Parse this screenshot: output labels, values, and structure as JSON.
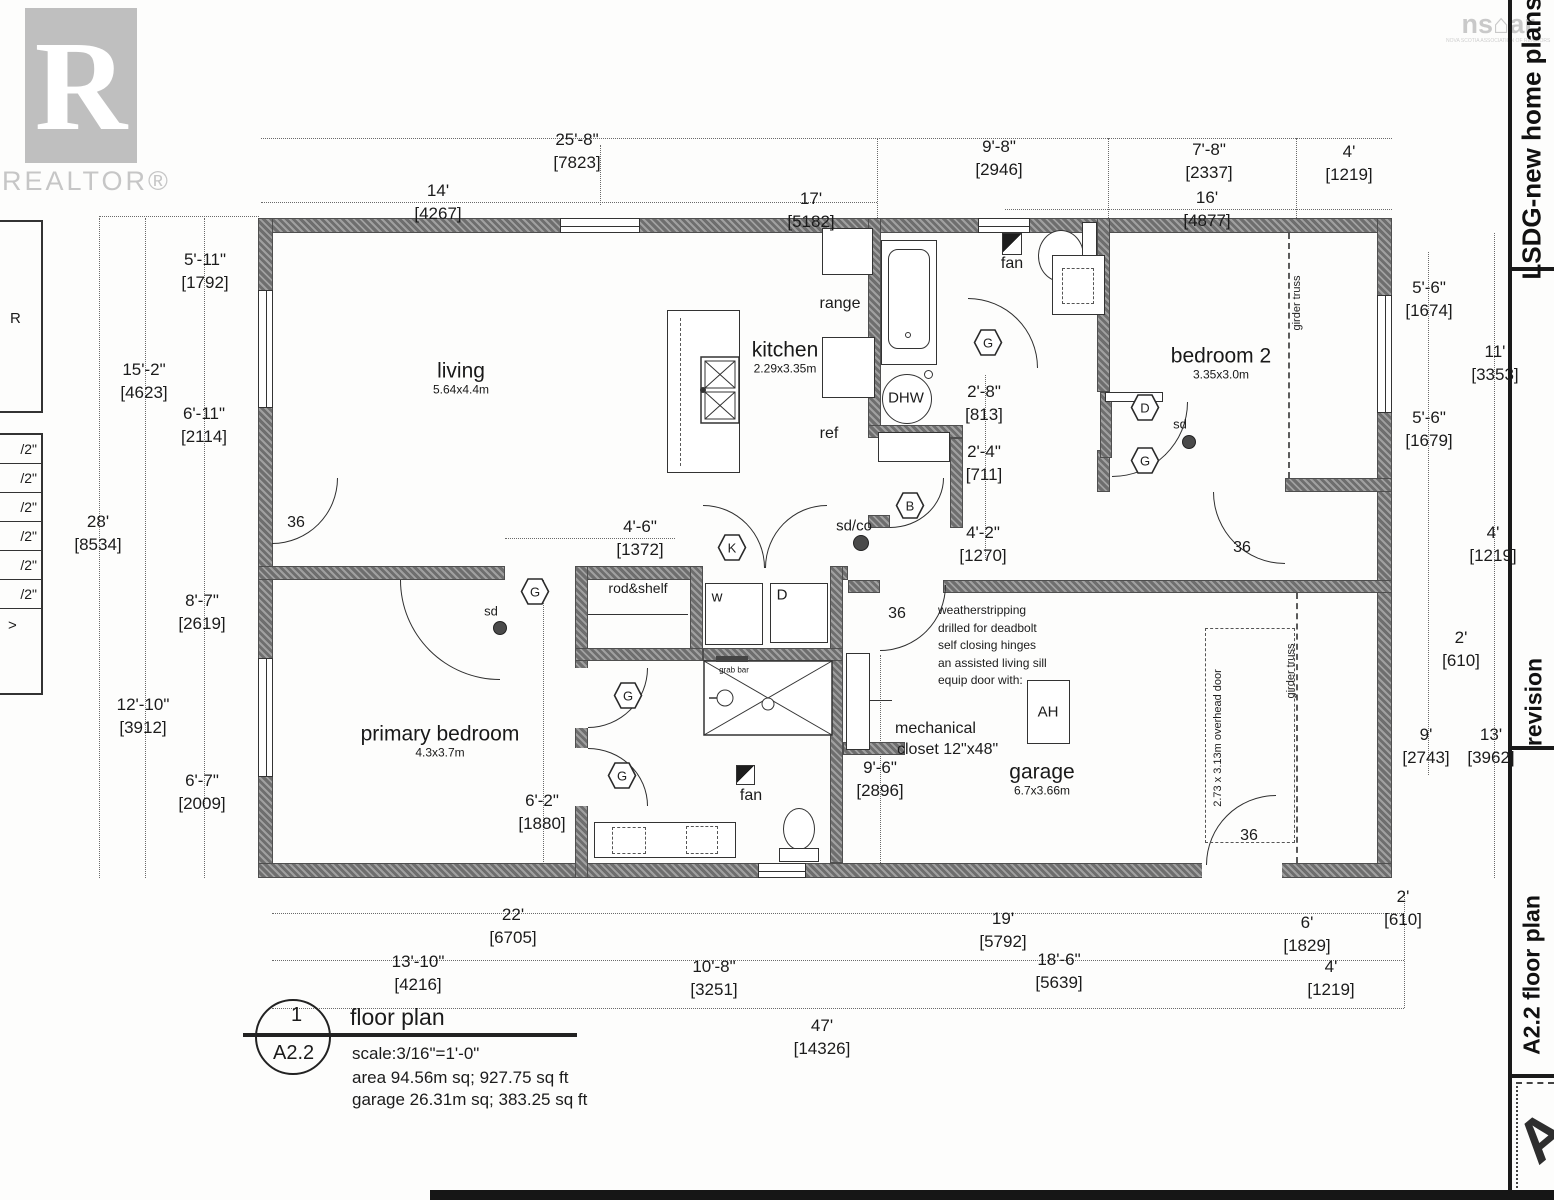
{
  "branding": {
    "realtor_r": "R",
    "realtor_text": "REALTOR®",
    "nsar_ns": "ns",
    "nsar_house": "⌂",
    "nsar_ar": "ar",
    "nsar_subtext": "NOVA SCOTIA ASSOCIATION OF REALTORS"
  },
  "right_sidebar": {
    "top": "LSDG-new home plans",
    "middle": "revision",
    "bottom": "A2.2 floor plan",
    "corner_letter": "A"
  },
  "left_schedule": {
    "r": "R",
    "rows": [
      "/2\"",
      "/2\"",
      "/2\"",
      "/2\"",
      "/2\"",
      "/2\""
    ],
    "last": ">"
  },
  "title_block": {
    "detail_number": "1",
    "sheet_number": "A2.2",
    "title": "floor plan",
    "scale": "scale:3/16\"=1'-0\"",
    "area": "area 94.56m sq; 927.75 sq ft",
    "garage": "garage 26.31m sq; 383.25 sq ft"
  },
  "plan": {
    "rooms": [
      {
        "name": "living",
        "size": "5.64x4.4m",
        "x": 461,
        "y": 378
      },
      {
        "name": "kitchen",
        "size": "2.29x3.35m",
        "x": 785,
        "y": 357
      },
      {
        "name": "bedroom 2",
        "size": "3.35x3.0m",
        "x": 1221,
        "y": 363
      },
      {
        "name": "primary bedroom",
        "size": "4.3x3.7m",
        "x": 440,
        "y": 741
      },
      {
        "name": "garage",
        "size": "6.7x3.66m",
        "x": 1042,
        "y": 779
      }
    ],
    "dimensions": [
      {
        "ft": "25'-8\"",
        "mm": "[7823]",
        "x": 577,
        "y": 151
      },
      {
        "ft": "14'",
        "mm": "[4267]",
        "x": 438,
        "y": 202
      },
      {
        "ft": "17'",
        "mm": "[5182]",
        "x": 811,
        "y": 210
      },
      {
        "ft": "9'-8\"",
        "mm": "[2946]",
        "x": 999,
        "y": 158
      },
      {
        "ft": "7'-8\"",
        "mm": "[2337]",
        "x": 1209,
        "y": 161
      },
      {
        "ft": "16'",
        "mm": "[4877]",
        "x": 1207,
        "y": 209
      },
      {
        "ft": "4'",
        "mm": "[1219]",
        "x": 1349,
        "y": 163
      },
      {
        "ft": "5'-11\"",
        "mm": "[1792]",
        "x": 205,
        "y": 271
      },
      {
        "ft": "15'-2\"",
        "mm": "[4623]",
        "x": 144,
        "y": 381
      },
      {
        "ft": "6'-11\"",
        "mm": "[2114]",
        "x": 204,
        "y": 425
      },
      {
        "ft": "28'",
        "mm": "[8534]",
        "x": 98,
        "y": 533
      },
      {
        "ft": "8'-7\"",
        "mm": "[2619]",
        "x": 202,
        "y": 612
      },
      {
        "ft": "12'-10\"",
        "mm": "[3912]",
        "x": 143,
        "y": 716
      },
      {
        "ft": "6'-7\"",
        "mm": "[2009]",
        "x": 202,
        "y": 792
      },
      {
        "ft": "5'-6\"",
        "mm": "[1674]",
        "x": 1429,
        "y": 299
      },
      {
        "ft": "11'",
        "mm": "[3353]",
        "x": 1495,
        "y": 363
      },
      {
        "ft": "5'-6\"",
        "mm": "[1679]",
        "x": 1429,
        "y": 429
      },
      {
        "ft": "4'",
        "mm": "[1219]",
        "x": 1493,
        "y": 544
      },
      {
        "ft": "2'",
        "mm": "[610]",
        "x": 1461,
        "y": 649
      },
      {
        "ft": "9'",
        "mm": "[2743]",
        "x": 1426,
        "y": 746
      },
      {
        "ft": "13'",
        "mm": "[3962]",
        "x": 1491,
        "y": 746
      },
      {
        "ft": "2'",
        "mm": "[610]",
        "x": 1403,
        "y": 908
      },
      {
        "ft": "22'",
        "mm": "[6705]",
        "x": 513,
        "y": 926
      },
      {
        "ft": "13'-10\"",
        "mm": "[4216]",
        "x": 418,
        "y": 973
      },
      {
        "ft": "10'-8\"",
        "mm": "[3251]",
        "x": 714,
        "y": 978
      },
      {
        "ft": "47'",
        "mm": "[14326]",
        "x": 822,
        "y": 1037
      },
      {
        "ft": "19'",
        "mm": "[5792]",
        "x": 1003,
        "y": 930
      },
      {
        "ft": "18'-6\"",
        "mm": "[5639]",
        "x": 1059,
        "y": 971
      },
      {
        "ft": "6'",
        "mm": "[1829]",
        "x": 1307,
        "y": 934
      },
      {
        "ft": "4'",
        "mm": "[1219]",
        "x": 1331,
        "y": 978
      },
      {
        "ft": "4'-6\"",
        "mm": "[1372]",
        "x": 640,
        "y": 538
      },
      {
        "ft": "6'-2\"",
        "mm": "[1880]",
        "x": 542,
        "y": 812
      },
      {
        "ft": "2'-8\"",
        "mm": "[813]",
        "x": 984,
        "y": 403
      },
      {
        "ft": "2'-4\"",
        "mm": "[711]",
        "x": 984,
        "y": 463
      },
      {
        "ft": "4'-2\"",
        "mm": "[1270]",
        "x": 983,
        "y": 544
      },
      {
        "ft": "9'-6\"",
        "mm": "[2896]",
        "x": 880,
        "y": 779
      }
    ],
    "labels": [
      {
        "text": "range",
        "x": 840,
        "y": 304,
        "fs": 16
      },
      {
        "text": "ref",
        "x": 829,
        "y": 434,
        "fs": 16
      },
      {
        "text": "DHW",
        "x": 906,
        "y": 398,
        "fs": 15
      },
      {
        "text": "fan",
        "x": 1012,
        "y": 264,
        "fs": 16
      },
      {
        "text": "fan",
        "x": 751,
        "y": 796,
        "fs": 16
      },
      {
        "text": "w",
        "x": 717,
        "y": 597,
        "fs": 15
      },
      {
        "text": "D",
        "x": 782,
        "y": 595,
        "fs": 15
      },
      {
        "text": "rod&shelf",
        "x": 638,
        "y": 588,
        "fs": 14
      },
      {
        "text": "grab bar",
        "x": 734,
        "y": 670,
        "fs": 8
      },
      {
        "text": "mechanical",
        "x": 895,
        "y": 729,
        "fs": 16,
        "anchor": "left"
      },
      {
        "text": "closet  12\"x48\"",
        "x": 897,
        "y": 750,
        "fs": 16,
        "anchor": "left"
      },
      {
        "text": "AH",
        "x": 1048,
        "y": 712,
        "fs": 15
      },
      {
        "text": "sd",
        "x": 491,
        "y": 611,
        "fs": 13
      },
      {
        "text": "sd",
        "x": 1180,
        "y": 424,
        "fs": 13
      },
      {
        "text": "sd/co",
        "x": 854,
        "y": 526,
        "fs": 15
      },
      {
        "text": "girder truss",
        "x": 1297,
        "y": 303,
        "fs": 11,
        "rot": -90
      },
      {
        "text": "girder truss",
        "x": 1291,
        "y": 671,
        "fs": 11,
        "rot": -90
      },
      {
        "text": "2.73 x 3.13m overhead door",
        "x": 1218,
        "y": 738,
        "fs": 11,
        "rot": -90
      }
    ],
    "door_labels": [
      {
        "text": "36",
        "x": 296,
        "y": 523
      },
      {
        "text": "36",
        "x": 897,
        "y": 614
      },
      {
        "text": "36",
        "x": 1242,
        "y": 548
      },
      {
        "text": "36",
        "x": 1249,
        "y": 836
      }
    ],
    "hexes": [
      {
        "letter": "G",
        "x": 988,
        "y": 345
      },
      {
        "letter": "D",
        "x": 1145,
        "y": 410
      },
      {
        "letter": "G",
        "x": 1145,
        "y": 463
      },
      {
        "letter": "B",
        "x": 910,
        "y": 508
      },
      {
        "letter": "K",
        "x": 732,
        "y": 550
      },
      {
        "letter": "G",
        "x": 535,
        "y": 594
      },
      {
        "letter": "G",
        "x": 628,
        "y": 698
      },
      {
        "letter": "G",
        "x": 622,
        "y": 778
      }
    ],
    "dots": [
      {
        "x": 500,
        "y": 628,
        "r": 7
      },
      {
        "x": 1189,
        "y": 442,
        "r": 7
      },
      {
        "x": 861,
        "y": 543,
        "r": 8
      }
    ],
    "note": {
      "x": 938,
      "y": 602,
      "lines": [
        "weatherstripping",
        "drilled for deadbolt",
        "self closing hinges",
        "an assisted living sill",
        "equip door with:"
      ]
    }
  }
}
